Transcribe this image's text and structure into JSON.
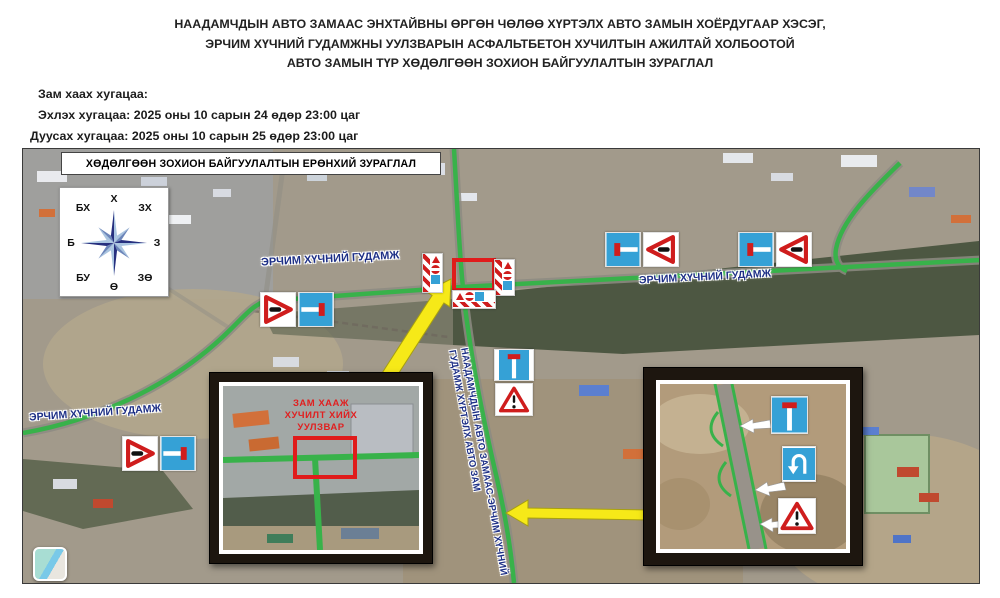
{
  "title": {
    "line1": "НААДАМЧДЫН АВТО ЗАМААС ЭНХТАЙВНЫ ӨРГӨН ЧӨЛӨӨ ХҮРТЭЛХ АВТО ЗАМЫН ХОЁРДУГААР ХЭСЭГ,",
    "line2": "ЭРЧИМ ХҮЧНИЙ ГУДАМЖНЫ УУЛЗВАРЫН АСФАЛЬТБЕТОН ХУЧИЛТЫН АЖИЛТАЙ ХОЛБООТОЙ",
    "line3": "АВТО ЗАМЫН ТҮР ХӨДӨЛГӨӨН ЗОХИОН БАЙГУУЛАЛТЫН ЗУРАГЛАЛ"
  },
  "schedule": {
    "heading": "Зам хаах хугацаа:",
    "start": "Эхлэх хугацаа: 2025 оны 10 сарын 24 өдөр 23:00 цаг",
    "end": "Дуусах хугацаа: 2025 оны 10 сарын 25 өдөр 23:00 цаг"
  },
  "map": {
    "overview_label": "ХӨДӨЛГӨӨН ЗОХИОН БАЙГУУЛАЛТЫН ЕРӨНХИЙ ЗУРАГЛАЛ",
    "street_label": "ЭРЧИМ ХҮЧНИЙ ГУДАМЖ",
    "corridor_label_line1": "НААДАМЧДЫН АВТО ЗАМААС-ЭРЧИМ ХҮЧНИЙ",
    "corridor_label_line2": "ГУДАМЖ ХҮРТЭЛХ АВТО ЗАМ",
    "compass": {
      "n": "Х",
      "ne": "ЗХ",
      "e": "З",
      "se": "ЗӨ",
      "s": "Ө",
      "sw": "БУ",
      "w": "Б",
      "nw": "БХ"
    },
    "inset_left_caption": {
      "line1": "ЗАМ ХААЖ",
      "line2": "ХУЧИЛТ ХИЙХ",
      "line3": "УУЛЗВАР"
    },
    "colors": {
      "road_green": "#38b24a",
      "sign_blue": "#35a1d6",
      "sign_red": "#cf1d1d",
      "marker_red": "#e01b1b",
      "arrow_yellow": "#f6e918",
      "label_navy": "#1d2f86"
    }
  }
}
